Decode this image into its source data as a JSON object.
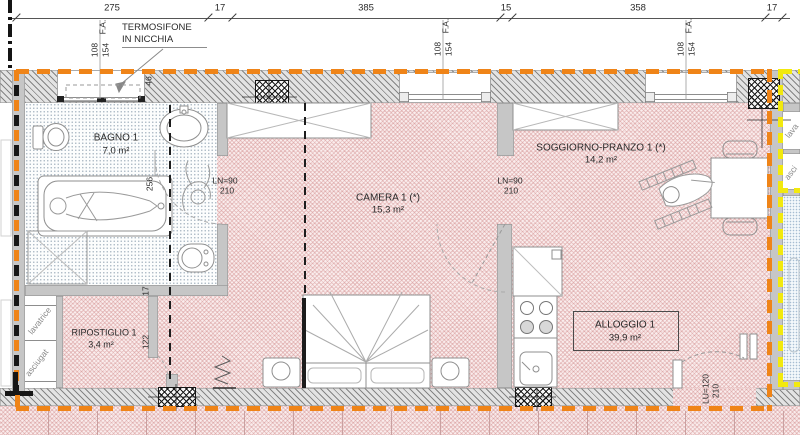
{
  "colors": {
    "boundary_orange": "#ef8418",
    "adjacent_yellow": "#f2e90e",
    "floor_pink_hatch": "#c87676",
    "wall_gray": "#c6c6c6"
  },
  "dims": [
    "275",
    "17",
    "385",
    "15",
    "358",
    "17"
  ],
  "fa": {
    "code": "F.A.",
    "w": "108",
    "h": "154"
  },
  "note": {
    "l1": "TERMOSIFONE",
    "l2": "IN NICCHIA"
  },
  "vdim": {
    "niche": "46",
    "bath": "256",
    "w17": "17",
    "rip": "122"
  },
  "rooms": {
    "bagno": {
      "name": "BAGNO 1",
      "area": "7,0 m²"
    },
    "camera": {
      "name": "CAMERA 1 (*)",
      "area": "15,3 m²"
    },
    "soggiorno": {
      "name": "SOGGIORNO-PRANZO 1 (*)",
      "area": "14,2 m²"
    },
    "ripostiglio": {
      "name": "RIPOSTIGLIO 1",
      "area": "3,4 m²"
    },
    "alloggio": {
      "name": "ALLOGGIO 1",
      "area": "39,9 m²"
    }
  },
  "doors": {
    "bagno_door": {
      "label": "LN=90",
      "height": "210"
    },
    "soggiorno_door": {
      "label": "LN=90",
      "height": "210"
    },
    "entry_door": {
      "label": "LU=120",
      "height": "210"
    }
  },
  "appl": {
    "l1": "lavatrice",
    "l2": "asciugat",
    "r1": "lava",
    "r2": "asci"
  }
}
